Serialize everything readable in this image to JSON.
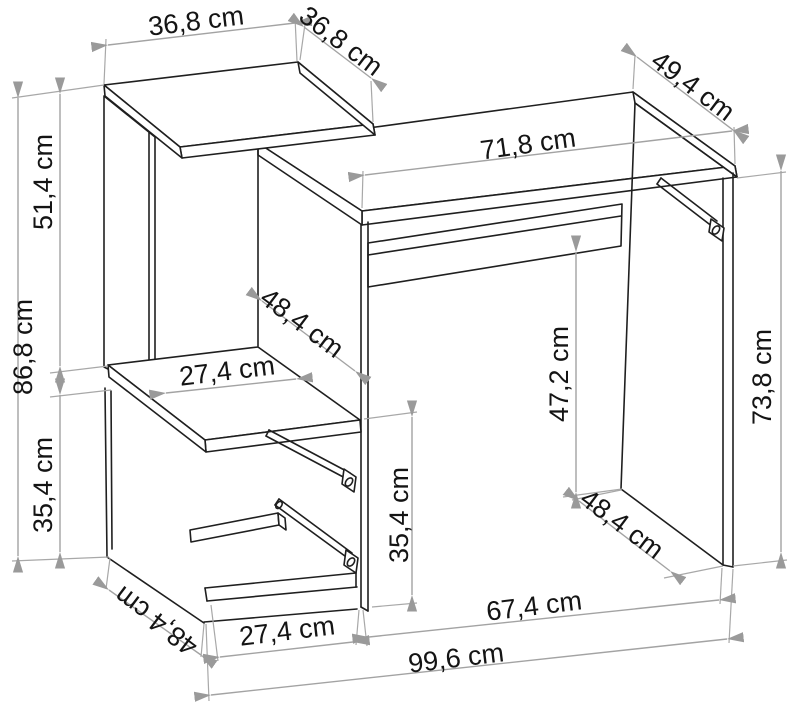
{
  "diagram": {
    "type": "furniture-dimension-drawing",
    "subject": "computer desk with side shelving unit",
    "unit": "cm",
    "labels": {
      "top_shelf_width": "36,8 cm",
      "top_shelf_depth": "36,8 cm",
      "desktop_depth": "49,4 cm",
      "desktop_width": "71,8 cm",
      "upper_section_height": "51,4 cm",
      "left_total_height": "86,8 cm",
      "lower_left_section_height": "35,4 cm",
      "middle_compartment_depth": "48,4 cm",
      "middle_shelf_width": "27,4 cm",
      "cabinet_opening_height": "35,4 cm",
      "under_desktop_height": "47,2 cm",
      "right_side_height": "73,8 cm",
      "right_side_depth": "48,4 cm",
      "knee_space_width": "67,4 cm",
      "cabinet_bottom_width": "27,4 cm",
      "total_width": "99,6 cm",
      "cabinet_side_depth": "48,4 cm"
    }
  }
}
